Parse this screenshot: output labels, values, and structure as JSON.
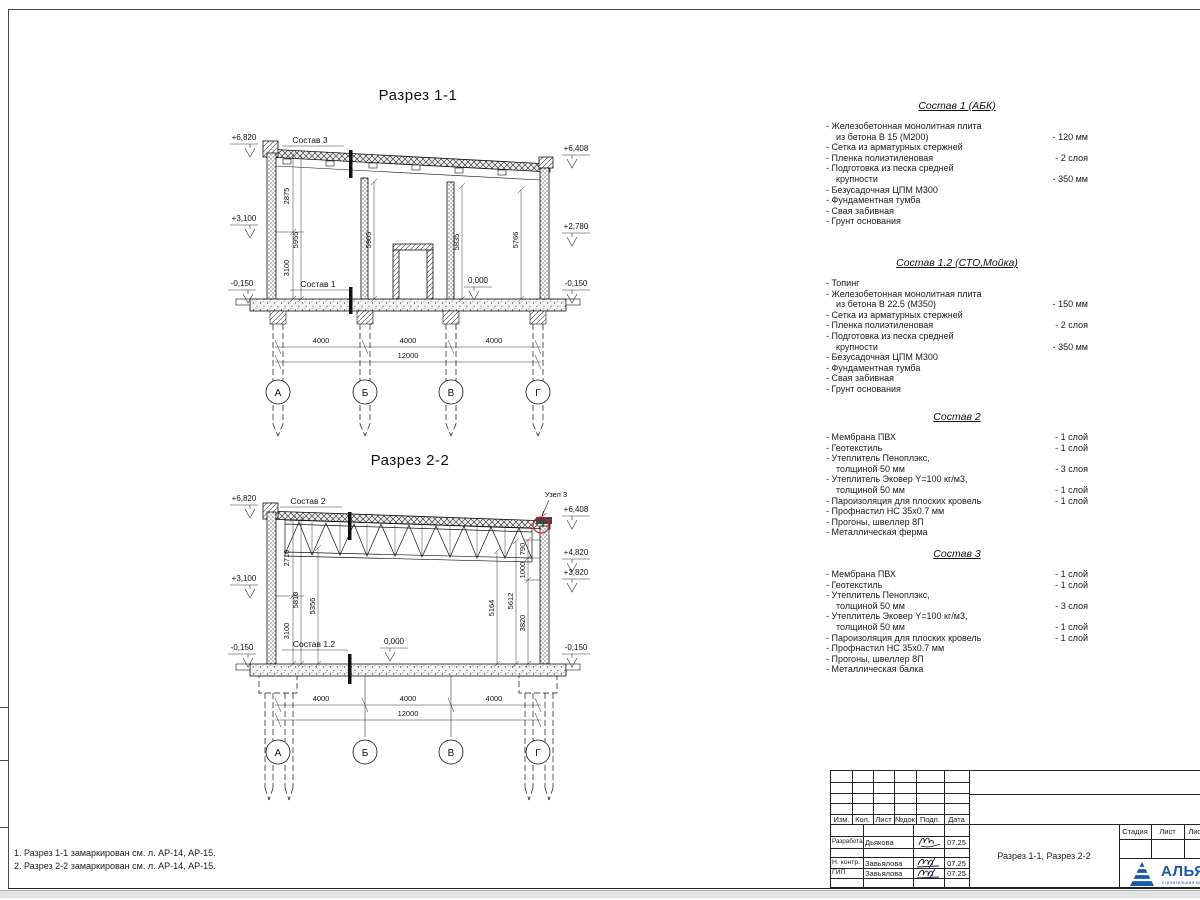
{
  "sheet": {
    "notes": [
      "1. Разрез 1-1 замаркирован см. л. АР-14, АР-15.",
      "2. Разрез 2-2 замаркирован см. л. АР-14, АР-15."
    ]
  },
  "axes": [
    "А",
    "Б",
    "В",
    "Г"
  ],
  "colors": {
    "detail_red": "#cc2222",
    "logo_blue": "#1a57ad"
  },
  "section1": {
    "title": "Разрез 1-1",
    "comp_top": "Состав 3",
    "comp_floor": "Состав 1",
    "elev": {
      "tl": "+6,820",
      "ml": "+3,100",
      "bl": "-0,150",
      "tr": "+6,408",
      "mr": "+2,780",
      "br": "-0,150",
      "zero": "0,000"
    },
    "vdims": [
      "2875",
      "5955",
      "3100",
      "5905",
      "5835",
      "5766"
    ],
    "hdims": [
      "4000",
      "4000",
      "4000"
    ],
    "hdim_total": "12000"
  },
  "section2": {
    "title": "Разрез 2-2",
    "comp_top": "Состав 2",
    "comp_floor": "Состав 1.2",
    "detail": "Узел 3",
    "elev": {
      "tl": "+6,820",
      "ml": "+3,100",
      "bl": "-0,150",
      "tr": "+6,408",
      "r1": "+4,820",
      "r2": "+3,820",
      "br": "-0,150",
      "zero": "0,000"
    },
    "vdims": [
      "2710",
      "5810",
      "5356",
      "3100",
      "5164",
      "5612",
      "3820",
      "1000",
      "790"
    ],
    "hdims": [
      "4000",
      "4000",
      "4000"
    ],
    "hdim_total": "12000"
  },
  "specs": [
    {
      "title": "Состав 1 (АБК)",
      "rows": [
        {
          "t": "- Железобетонная  монолитная плита",
          "v": ""
        },
        {
          "t": "из бетона В 15 (М200)",
          "v": "- 120 мм",
          "i": 1
        },
        {
          "t": "- Сетка из арматурных стержней",
          "v": ""
        },
        {
          "t": "- Пленка полиэтиленовая",
          "v": "- 2 слоя"
        },
        {
          "t": "- Подготовка из песка средней",
          "v": ""
        },
        {
          "t": "крупности",
          "v": "- 350 мм",
          "i": 1
        },
        {
          "t": "- Безусадочная ЦПМ М300",
          "v": ""
        },
        {
          "t": "- Фундаментная тумба",
          "v": ""
        },
        {
          "t": "- Свая забивная",
          "v": ""
        },
        {
          "t": "- Грунт основания",
          "v": ""
        }
      ]
    },
    {
      "title": "Состав 1.2 (СТО,Мойка)",
      "rows": [
        {
          "t": "- Топинг",
          "v": ""
        },
        {
          "t": "- Железобетонная  монолитная плита",
          "v": ""
        },
        {
          "t": "из бетона В 22.5 (М350)",
          "v": "- 150 мм",
          "i": 1
        },
        {
          "t": "- Сетка из арматурных стержней",
          "v": ""
        },
        {
          "t": "- Пленка полиэтиленовая",
          "v": "- 2 слоя"
        },
        {
          "t": "- Подготовка из песка средней",
          "v": ""
        },
        {
          "t": "крупности",
          "v": "- 350 мм",
          "i": 1
        },
        {
          "t": "- Безусадочная ЦПМ М300",
          "v": ""
        },
        {
          "t": "- Фундаментная тумба",
          "v": ""
        },
        {
          "t": "- Свая забивная",
          "v": ""
        },
        {
          "t": "- Грунт основания",
          "v": ""
        }
      ]
    },
    {
      "title": "Состав 2",
      "rows": [
        {
          "t": "- Мембрана ПВХ",
          "v": "- 1 слой"
        },
        {
          "t": "- Геотекстиль",
          "v": "- 1 слой"
        },
        {
          "t": "- Утеплитель Пеноплэкс,",
          "v": ""
        },
        {
          "t": "толщиной 50 мм",
          "v": "- 3 слоя",
          "i": 1
        },
        {
          "t": "- Утеплитель Эковер Y=100 кг/м3,",
          "v": ""
        },
        {
          "t": "толщиной 50 мм",
          "v": "- 1 слой",
          "i": 1
        },
        {
          "t": "- Пароизоляция для плоских кровель",
          "v": "- 1 слой"
        },
        {
          "t": "- Профнастил НС 35х0.7 мм",
          "v": ""
        },
        {
          "t": "- Прогоны, швеллер 8П",
          "v": ""
        },
        {
          "t": "- Металлическая ферма",
          "v": ""
        }
      ]
    },
    {
      "title": "Состав 3",
      "rows": [
        {
          "t": "- Мембрана ПВХ",
          "v": "- 1 слой"
        },
        {
          "t": "- Геотекстиль",
          "v": "- 1 слой"
        },
        {
          "t": "- Утеплитель Пеноплэкс,",
          "v": ""
        },
        {
          "t": "толщиной 50 мм",
          "v": "- 3 слоя",
          "i": 1
        },
        {
          "t": "- Утеплитель Эковер Y=100 кг/м3,",
          "v": ""
        },
        {
          "t": "толщиной 50 мм",
          "v": "- 1 слой",
          "i": 1
        },
        {
          "t": "- Пароизоляция для плоских кровель",
          "v": "- 1 слой"
        },
        {
          "t": "- Профнастил НС 35х0.7 мм",
          "v": ""
        },
        {
          "t": "- Прогоны, швеллер 8П",
          "v": ""
        },
        {
          "t": "- Металлическая балка",
          "v": ""
        }
      ]
    }
  ],
  "titleblock": {
    "header_cols": [
      "Изм.",
      "Кол.",
      "Лист",
      "№док",
      "Подп.",
      "Дата"
    ],
    "rows": [
      {
        "role": "Разработал",
        "name": "Дьякова",
        "date": "07.25"
      },
      {
        "role": "Н. контр.",
        "name": "Завьялова",
        "date": "07.25"
      },
      {
        "role": "ГИП",
        "name": "Завьялова",
        "date": "07.25"
      }
    ],
    "doc_title": "Разрез 1-1, Разрез 2-2",
    "stage_cols": [
      "Стадия",
      "Лист",
      "Листов"
    ],
    "company": "АЛЬЯНС",
    "company_sub": "строительная компания"
  }
}
